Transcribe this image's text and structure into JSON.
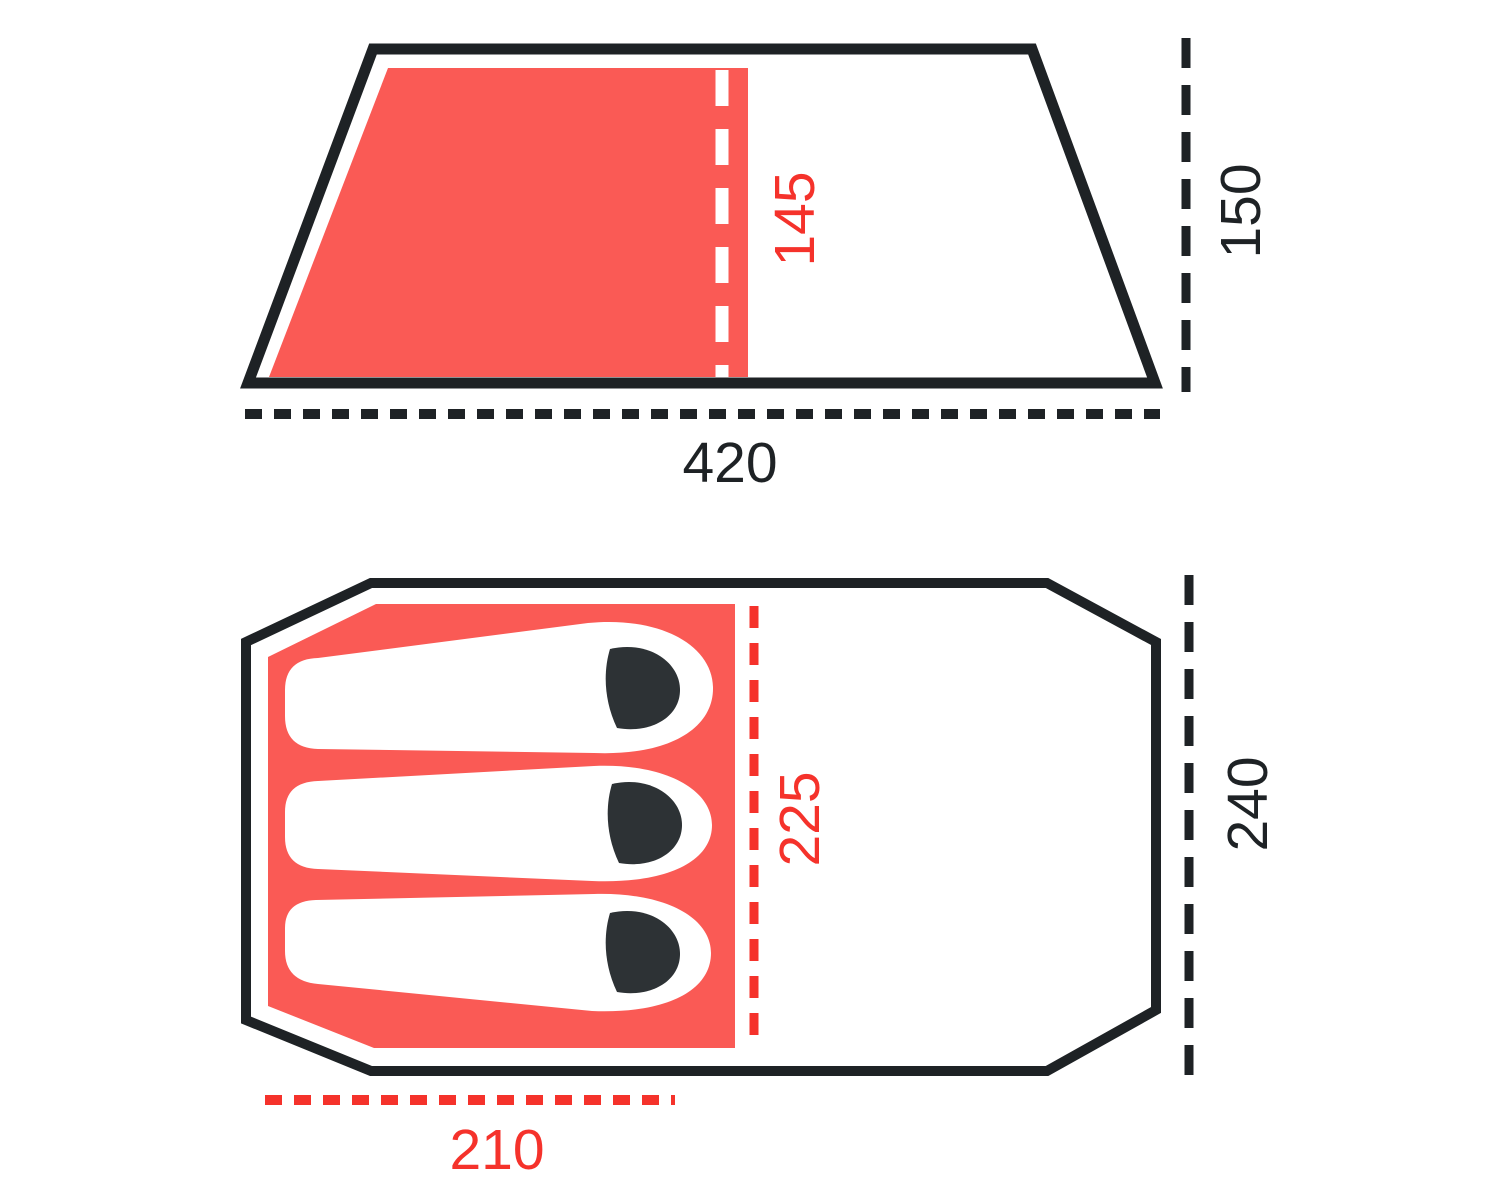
{
  "colors": {
    "outline": "#1E2225",
    "area_fill": "#FA5A55",
    "accent": "#F5322B",
    "figure_dark": "#2D3235",
    "bag_fill": "#FFFFFF",
    "divider_white": "#FFFFFF",
    "background": "#FFFFFF"
  },
  "side_view": {
    "length_label": "420",
    "height_label": "150",
    "inner_height_label": "145"
  },
  "floor_plan": {
    "width_label": "240",
    "inner_length_label": "225",
    "sleeping_area_width_label": "210",
    "sleeping_bag_count": "3"
  }
}
